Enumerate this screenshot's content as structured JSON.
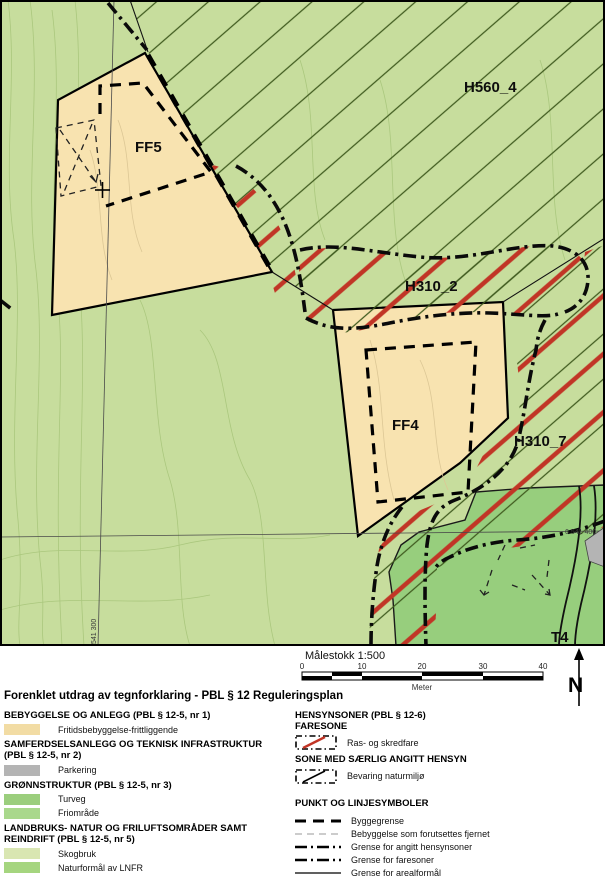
{
  "map": {
    "labels": {
      "h560": "H560_4",
      "ff5": "FF5",
      "h310_2": "H310_2",
      "ff4": "FF4",
      "h310_7": "H310_7",
      "t4": "T4"
    },
    "grid": {
      "easting_label": "541 300",
      "northing_label": "6 541 400"
    },
    "scalebar": {
      "title": "Målestokk 1:500",
      "ticks": [
        "0",
        "10",
        "20",
        "30",
        "40"
      ],
      "unit": "Meter"
    },
    "north_label": "N",
    "colors": {
      "background_green": "#c7dd9d",
      "dark_green": "#97ce7d",
      "zone_tan": "#f8e3b0",
      "hazard_red": "#c13526",
      "hatch_line": "#3f5a1e",
      "parking_gray": "#b4b4b4",
      "contour": "#a9c67c"
    }
  },
  "legend": {
    "title": "Forenklet utdrag av tegnforklaring - PBL § 12 Reguleringsplan",
    "left_sections": [
      {
        "heading": "BEBYGGELSE OG ANLEGG (PBL § 12-5, nr 1)",
        "items": [
          {
            "label": "Fritidsbebyggelse-frittliggende",
            "color": "#f2dca4"
          }
        ]
      },
      {
        "heading": "SAMFERDSELSANLEGG OG TEKNISK INFRASTRUKTUR (PBL § 12-5, nr 2)",
        "items": [
          {
            "label": "Parkering",
            "color": "#b4b4b4"
          }
        ]
      },
      {
        "heading": "GRØNNSTRUKTUR (PBL § 12-5, nr 3)",
        "items": [
          {
            "label": "Turveg",
            "color": "#9bce7d"
          },
          {
            "label": "Friområde",
            "color": "#a9d88c"
          }
        ]
      },
      {
        "heading": "LANDBRUKS- NATUR OG FRILUFTSOMRÅDER SAMT REINDRIFT (PBL § 12-5, nr 5)",
        "items": [
          {
            "label": "Skogbruk",
            "color": "#d9e6b2"
          },
          {
            "label": "Naturformål av LNFR",
            "color": "#a5d57f"
          }
        ]
      }
    ],
    "right": {
      "hensynsoner_heading": "HENSYNSONER (PBL § 12-6)",
      "faresone_heading": "FARESONE",
      "faresone_item": "Ras- og skredfare",
      "saerlig_heading": "SONE MED SÆRLIG ANGITT HENSYN",
      "saerlig_item": "Bevaring naturmiljø",
      "lines_heading": "PUNKT OG LINJESYMBOLER",
      "line_items": [
        "Byggegrense",
        "Bebyggelse som forutsettes fjernet",
        "Grense for angitt hensynsoner",
        "Grense for faresoner",
        "Grense for arealformål"
      ]
    }
  }
}
